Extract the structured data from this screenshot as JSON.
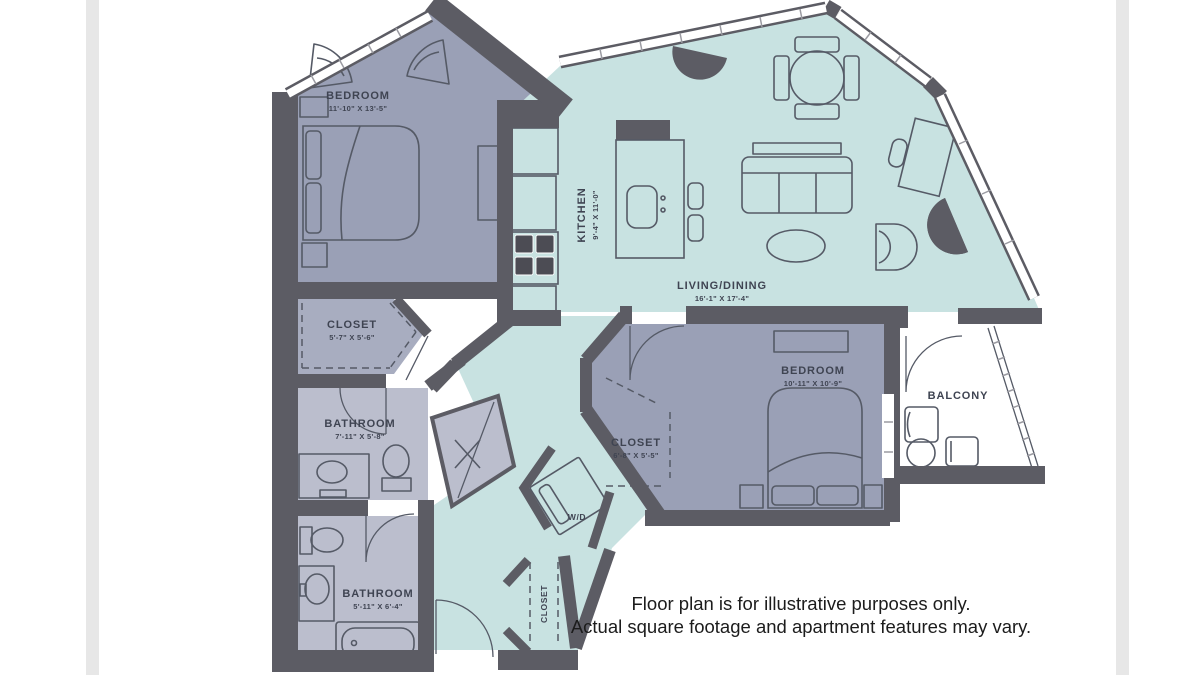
{
  "colors": {
    "wall": "#5c5c64",
    "bedroom": "#9aa0b6",
    "closet1": "#a8adc0",
    "bathroom": "#bbbecd",
    "living": "#c8e2e1",
    "furniture": "#555a66",
    "label": "#3f4452",
    "disclaimer": "#1c1c1c"
  },
  "rooms": {
    "bedroom1": {
      "name": "BEDROOM",
      "dims": "11'-10\" X 13'-5\""
    },
    "closet1": {
      "name": "CLOSET",
      "dims": "5'-7\" X 5'-6\""
    },
    "bathroom1": {
      "name": "BATHROOM",
      "dims": "7'-11\" X 5'-8\""
    },
    "kitchen": {
      "name": "KITCHEN",
      "dims": "9'-4\" X 11'-0\""
    },
    "living": {
      "name": "LIVING/DINING",
      "dims": "16'-1\" X 17'-4\""
    },
    "bedroom2": {
      "name": "BEDROOM",
      "dims": "10'-11\" X 10'-9\""
    },
    "closet2": {
      "name": "CLOSET",
      "dims": "6'-8\" X 5'-5\""
    },
    "bathroom2": {
      "name": "BATHROOM",
      "dims": "5'-11\" X 6'-4\""
    },
    "balcony": {
      "name": "BALCONY"
    },
    "washer_dryer": {
      "name": "W/D"
    },
    "closet3": {
      "name": "CLOSET"
    }
  },
  "disclaimer": {
    "line1": "Floor plan is for illustrative purposes only.",
    "line2": "Actual square footage and apartment features may vary."
  }
}
